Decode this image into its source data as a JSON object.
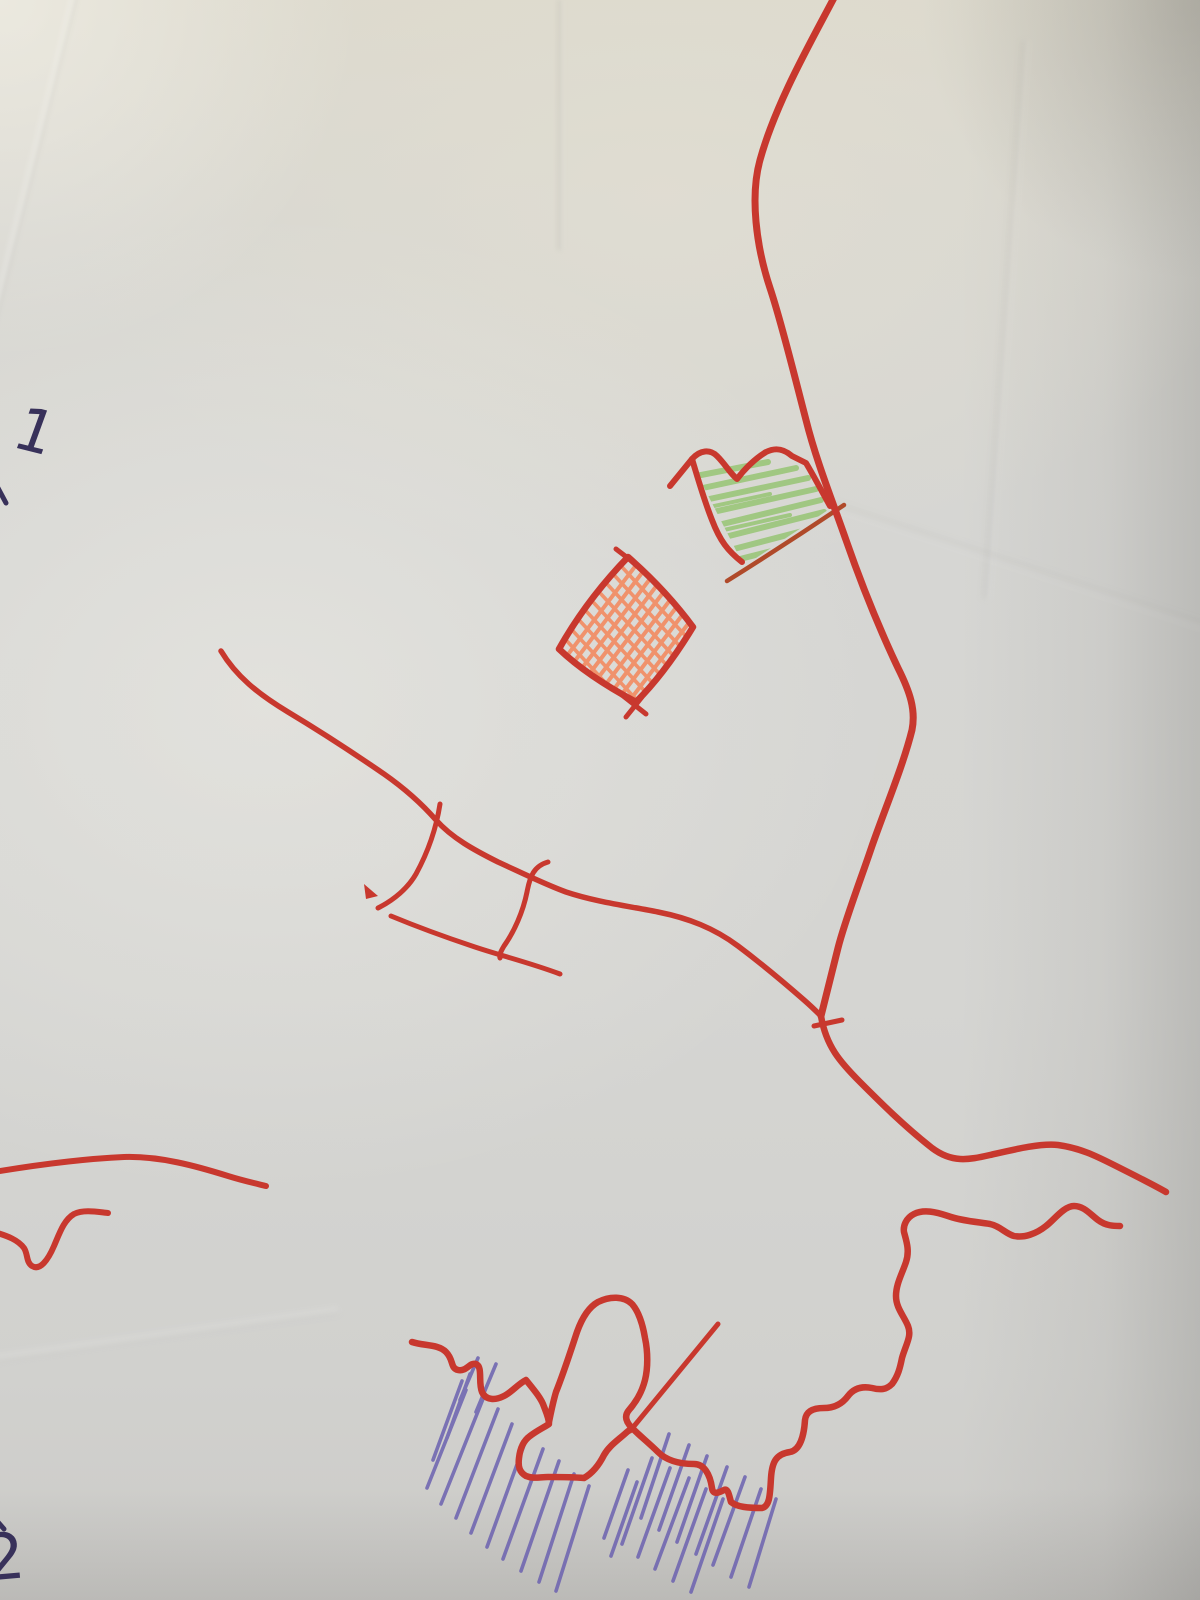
{
  "labels": {
    "marker_top_left": "1",
    "marker_bottom_left": "2"
  },
  "palette": {
    "road_red": "#c8382e",
    "baseline_brown": "#b04a2a",
    "field_orange": "#f28a61",
    "field_green": "#97c574",
    "water_blue": "#6c62b0",
    "ink_dark": "#38315a",
    "paper_light": "#dcd9cd",
    "paper_mid": "#d6d5d1",
    "paper_shadow": "#cccbc8"
  },
  "features": {
    "north_road": "curved road from top edge down to junction",
    "west_road": "road from upper left to junction",
    "bridge_crossing": "ladder-shaped crossing marks on west road",
    "junction_tick": "small tick at road junction",
    "coast_road": "road from junction toward right edge",
    "left_road": "road stub at left edge",
    "left_shore_zigzag": "small zigzag line at left edge",
    "green_field": "green hatched field with red outline",
    "orange_field": "orange cross-hatched square with red outline",
    "coastline": "wiggly red coastline with boot-shaped peninsula",
    "diagonal_line": "straight line from peninsula up to the right",
    "water_hatching": "blue diagonal pencil strokes marking water"
  }
}
